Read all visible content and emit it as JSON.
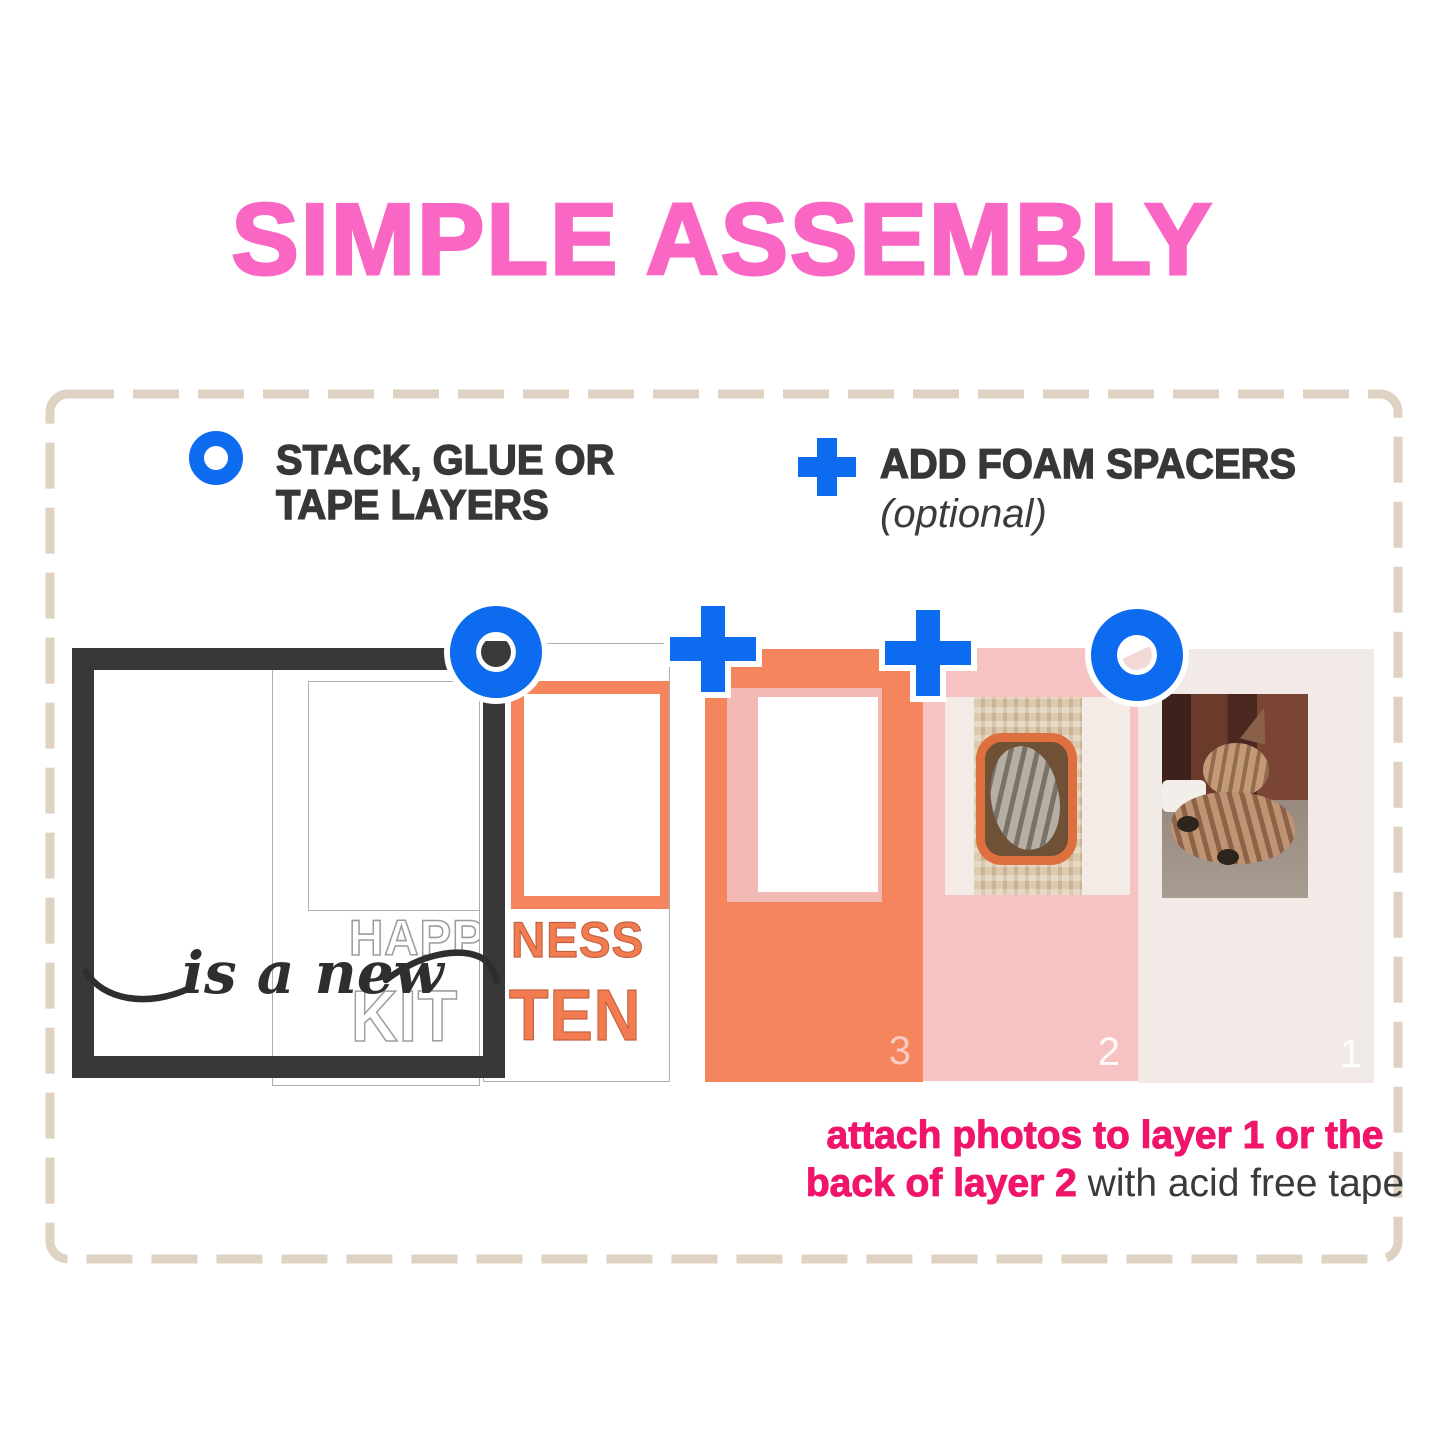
{
  "title": "SIMPLE ASSEMBLY",
  "legend": {
    "stack_line1": "STACK, GLUE OR",
    "stack_line2": "TAPE LAYERS",
    "foam_label": "ADD FOAM SPACERS",
    "foam_note": "(optional)"
  },
  "icons": {
    "stack_marker": "blue-ring-circle",
    "foam_marker": "blue-plus"
  },
  "stack": {
    "script_text": "is a new",
    "outline_card": {
      "word_top": "HAPP",
      "word_bottom": "KIT"
    },
    "orange_word_card": {
      "word_top": "NESS",
      "word_bottom": "TEN"
    },
    "orange_card": {
      "number": "3"
    },
    "pink_card": {
      "number": "2"
    },
    "base_card": {
      "number": "1"
    }
  },
  "caption": {
    "line1": "attach photos to layer 1 or the",
    "line2_bold": "back of layer 2",
    "line2_rest": " with acid free tape"
  },
  "colors": {
    "title_pink": "#F966C4",
    "accent_blue": "#0D6BF0",
    "orange": "#F5855C",
    "card_pink": "#F6C2C2",
    "card_cream": "#F2EAE6",
    "caption_pink": "#F0146B",
    "dash_tan": "#DFD2C3",
    "ink": "#3A3A3A"
  }
}
